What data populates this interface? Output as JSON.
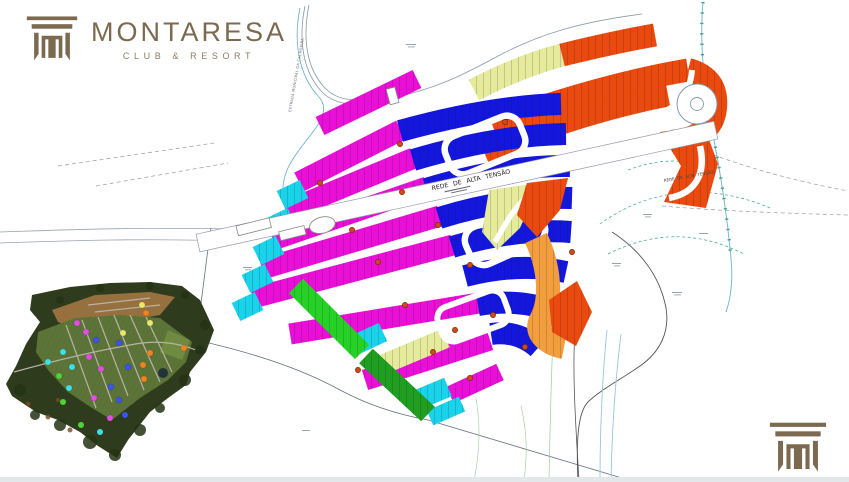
{
  "brand": {
    "name": "MONTARESA",
    "tagline": "CLUB & RESORT",
    "color": "#7c6a50",
    "color_soft": "#8d7d66"
  },
  "map": {
    "labels": {
      "power_line_main": "REDE DE ALTA TENSÃO",
      "power_line_secondary": "REDE DE ALTA TENSÃO",
      "road_left": "ESTRADA MUNICIPAL DA CACHOEIRA"
    },
    "colors": {
      "magenta": "#ea0fd6",
      "blue": "#1317dd",
      "cyan": "#19d3ea",
      "pale_yellow": "#e6eb9b",
      "orange": "#ea4a0d",
      "light_orange": "#f29e3d",
      "green": "#26d126",
      "dark_green": "#1f9e1f",
      "marker": "#cf4a1a"
    },
    "block_markers": [
      [
        320,
        183
      ],
      [
        402,
        192
      ],
      [
        352,
        230
      ],
      [
        438,
        225
      ],
      [
        378,
        262
      ],
      [
        470,
        265
      ],
      [
        405,
        305
      ],
      [
        493,
        315
      ],
      [
        433,
        352
      ],
      [
        470,
        378
      ],
      [
        525,
        347
      ],
      [
        572,
        252
      ],
      [
        358,
        370
      ],
      [
        400,
        144
      ],
      [
        505,
        122
      ],
      [
        455,
        330
      ]
    ]
  },
  "inset": {
    "dots": [
      {
        "x": 142,
        "y": 305,
        "c": "#e8e870"
      },
      {
        "x": 150,
        "y": 323,
        "c": "#e8e870"
      },
      {
        "x": 123,
        "y": 333,
        "c": "#e8e870"
      },
      {
        "x": 146,
        "y": 313,
        "c": "#ef8322"
      },
      {
        "x": 184,
        "y": 348,
        "c": "#ef8322"
      },
      {
        "x": 143,
        "y": 365,
        "c": "#ef8322"
      },
      {
        "x": 144,
        "y": 379,
        "c": "#ef8322"
      },
      {
        "x": 150,
        "y": 353,
        "c": "#ef8322"
      },
      {
        "x": 77,
        "y": 323,
        "c": "#e14fe1"
      },
      {
        "x": 86,
        "y": 332,
        "c": "#e14fe1"
      },
      {
        "x": 89,
        "y": 357,
        "c": "#e14fe1"
      },
      {
        "x": 101,
        "y": 369,
        "c": "#e14fe1"
      },
      {
        "x": 94,
        "y": 398,
        "c": "#e14fe1"
      },
      {
        "x": 110,
        "y": 418,
        "c": "#e14fe1"
      },
      {
        "x": 96,
        "y": 340,
        "c": "#3b55e8"
      },
      {
        "x": 119,
        "y": 343,
        "c": "#3b55e8"
      },
      {
        "x": 128,
        "y": 367,
        "c": "#3b55e8"
      },
      {
        "x": 111,
        "y": 387,
        "c": "#3b55e8"
      },
      {
        "x": 125,
        "y": 415,
        "c": "#3b55e8"
      },
      {
        "x": 119,
        "y": 400,
        "c": "#3b55e8"
      },
      {
        "x": 63,
        "y": 352,
        "c": "#3fe0e0"
      },
      {
        "x": 72,
        "y": 367,
        "c": "#3fe0e0"
      },
      {
        "x": 69,
        "y": 388,
        "c": "#3fe0e0"
      },
      {
        "x": 100,
        "y": 432,
        "c": "#3fe0e0"
      },
      {
        "x": 48,
        "y": 362,
        "c": "#3fe0e0"
      },
      {
        "x": 63,
        "y": 402,
        "c": "#4fd435"
      },
      {
        "x": 81,
        "y": 425,
        "c": "#4fd435"
      },
      {
        "x": 59,
        "y": 376,
        "c": "#4fd435"
      }
    ]
  }
}
